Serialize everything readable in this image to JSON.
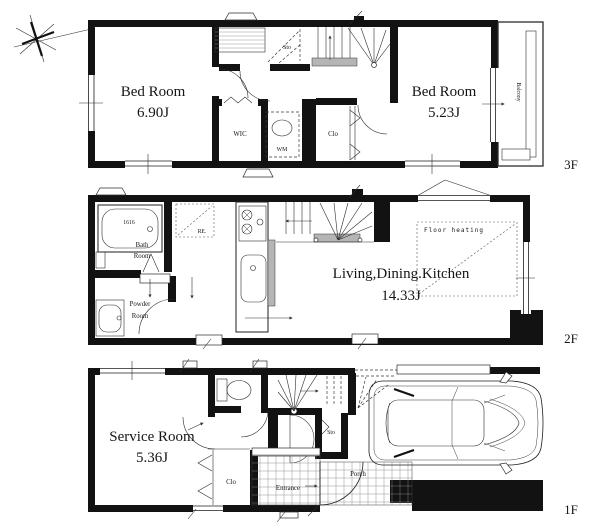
{
  "palette": {
    "wall": "#121212",
    "background": "#ffffff",
    "stair_tread": "#b5b5b5"
  },
  "floors": {
    "f3": {
      "label": "3F",
      "bedroom1": {
        "name": "Bed Room",
        "size": "6.90J"
      },
      "bedroom2": {
        "name": "Bed Room",
        "size": "5.23J"
      },
      "wic": "WIC",
      "wm": "WM",
      "sto": "Sto",
      "clo": "Clo",
      "balcony": "Balcony"
    },
    "f2": {
      "label": "2F",
      "ldk": {
        "name": "Living,Dining.Kitchen",
        "size": "14.33J"
      },
      "bath": {
        "line1": "Bath",
        "line2": "Room"
      },
      "tub_size": "1616",
      "fridge": "RE.",
      "powder": {
        "line1": "Powder",
        "line2": "Room"
      },
      "floor_heating": "Floor heating"
    },
    "f1": {
      "label": "1F",
      "service": {
        "name": "Service Room",
        "size": "5.36J"
      },
      "clo": "Clo",
      "sto": "Sto",
      "entrance": "Entrance",
      "porch": "Porch"
    }
  }
}
